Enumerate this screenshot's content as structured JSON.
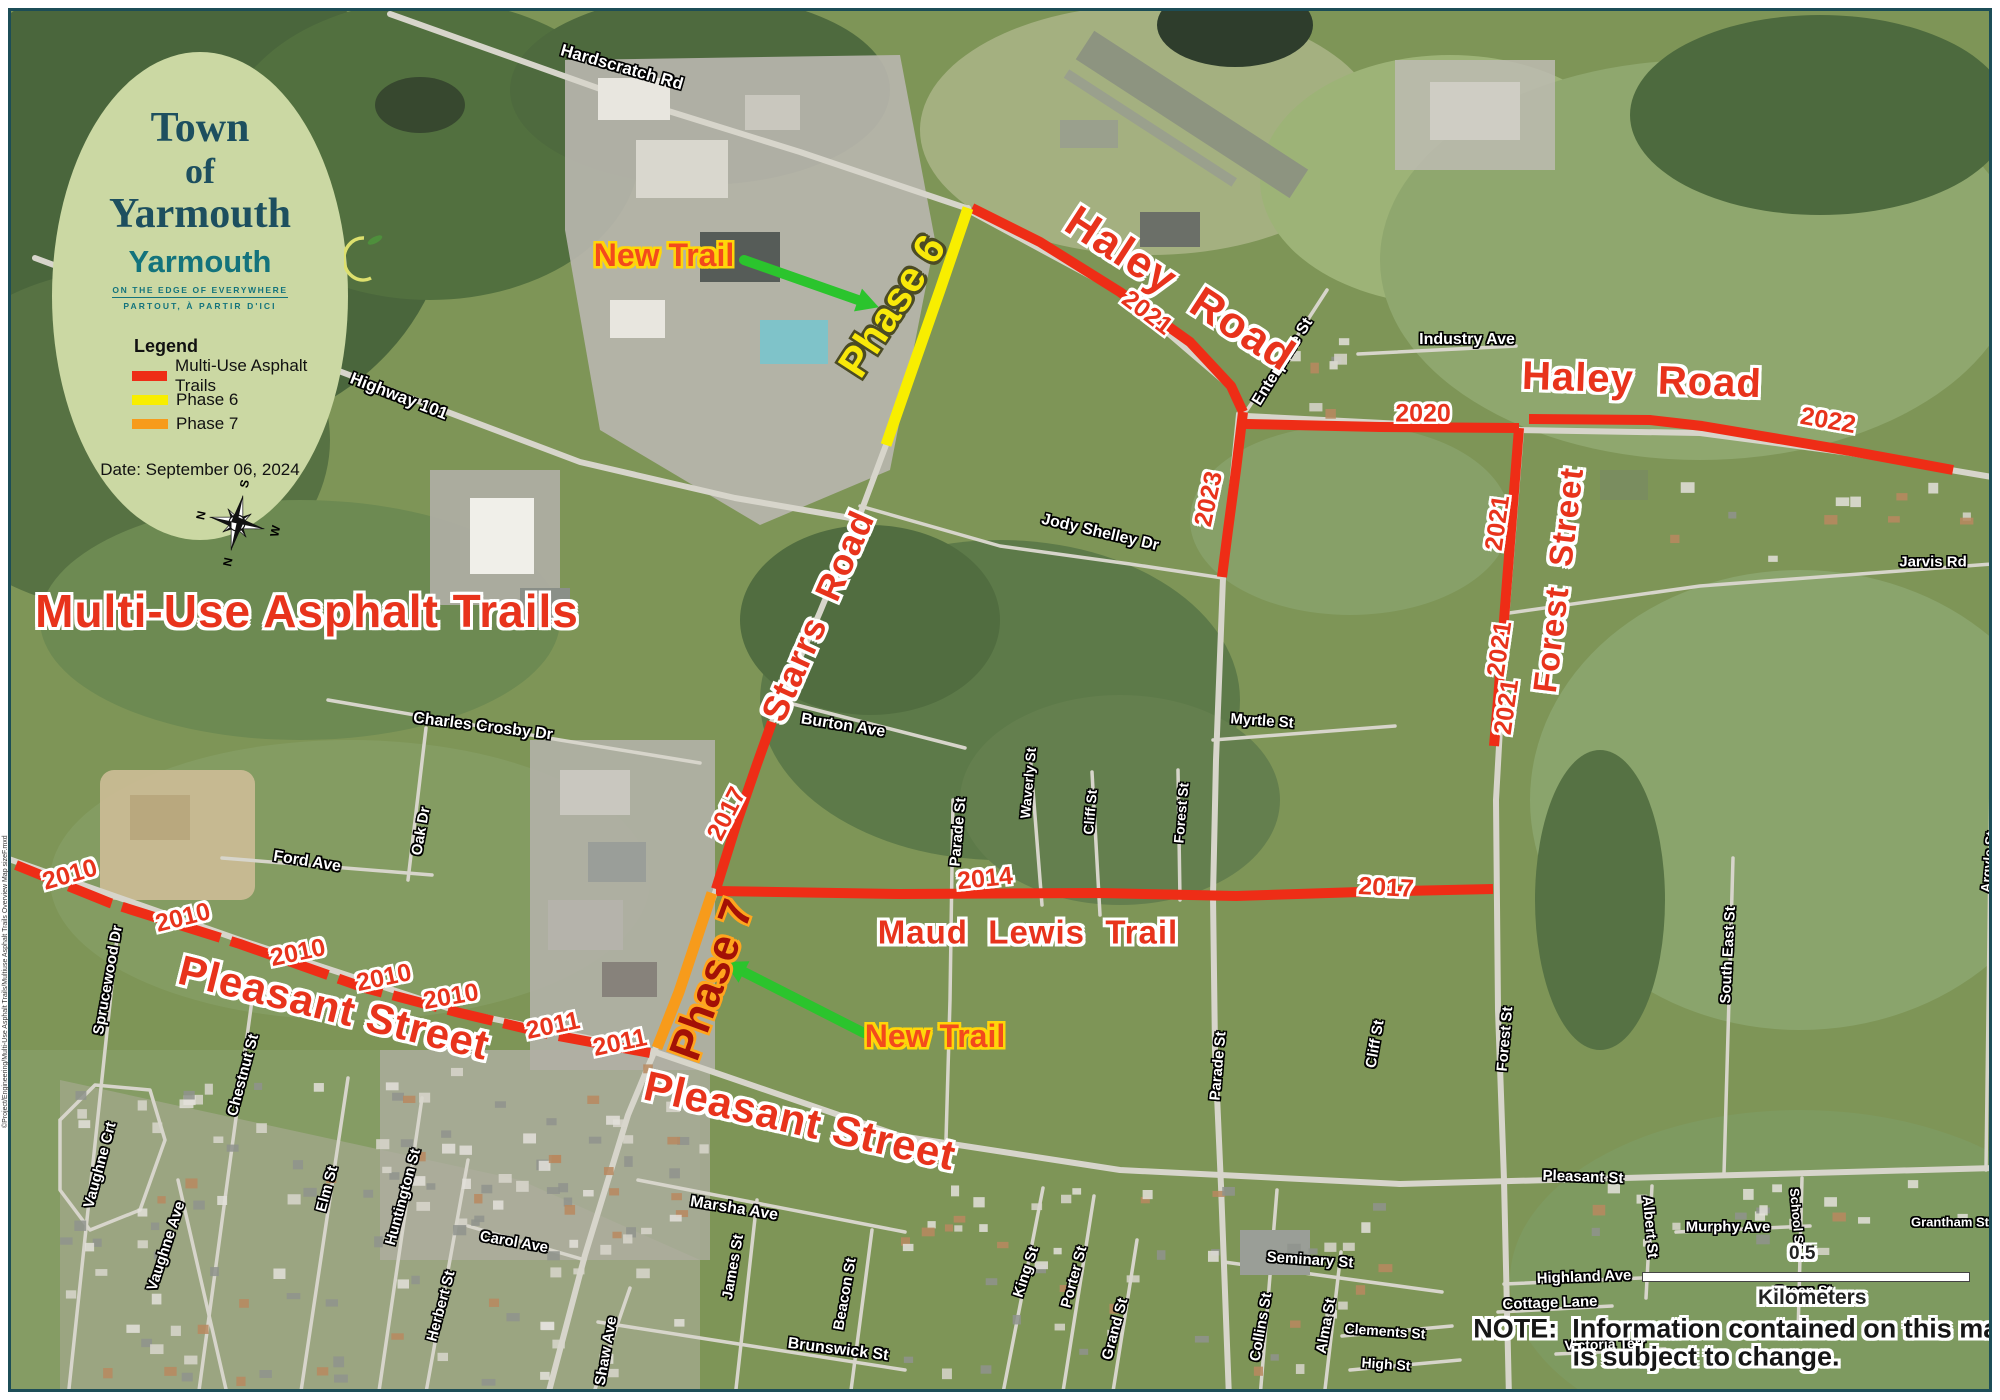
{
  "legend_card": {
    "title_line1": "Town",
    "title_line2": "of",
    "title_line3": "Yarmouth",
    "logo": {
      "name": "Yarmouth",
      "tagline1": "ON THE EDGE OF EVERYWHERE",
      "tagline2": "PARTOUT, À PARTIR D'ICI"
    },
    "legend_title": "Legend",
    "items": [
      {
        "label": "Multi-Use Asphalt Trails",
        "color": "#ee2d16"
      },
      {
        "label": "Phase 6",
        "color": "#f8ee00"
      },
      {
        "label": "Phase 7",
        "color": "#f79b1b"
      }
    ],
    "date_label": "Date: September 06, 2024",
    "compass": {
      "n": "N",
      "e": "E",
      "s": "S",
      "w": "W"
    }
  },
  "note": {
    "line1": "NOTE:  Information contained on this map",
    "line2": "is subject to change."
  },
  "scale_bar": {
    "value": "0.5",
    "unit": "Kilometers"
  },
  "credit_left": "©Project/Engineering/Multi-Use Asphalt Trails/Multiuse Asphalt Trails Overview Map sizeF.mxd",
  "colors": {
    "trail_red": "#ee2d16",
    "phase6_yellow": "#f8ee00",
    "phase7_orange": "#f79b1b",
    "label_red": "#e8331c",
    "arrow_green": "#2bc42d",
    "oval_bg": "#cbd8a3",
    "heading_teal": "#1d4f5f",
    "logo_teal": "#13737c",
    "border_teal": "#1c4d57"
  },
  "annotations": {
    "overlay_labels": [
      {
        "text": "Multi-Use Asphalt Trails",
        "x": 307,
        "y": 611,
        "rot": 0,
        "cls": "big-red",
        "size": 46
      },
      {
        "text": "Haley  Road",
        "x": 1180,
        "y": 289,
        "rot": 33,
        "cls": "big-red",
        "size": 44
      },
      {
        "text": "Haley  Road",
        "x": 1642,
        "y": 380,
        "rot": 2,
        "cls": "big-red",
        "size": 40
      },
      {
        "text": "Pleasant Street",
        "x": 334,
        "y": 1008,
        "rot": 14,
        "cls": "big-red",
        "size": 42
      },
      {
        "text": "Pleasant Street",
        "x": 800,
        "y": 1121,
        "rot": 13,
        "cls": "big-red",
        "size": 42
      },
      {
        "text": "Starrs  Road",
        "x": 818,
        "y": 616,
        "rot": -66,
        "cls": "big-red",
        "size": 36
      },
      {
        "text": "Forest  Street",
        "x": 1558,
        "y": 580,
        "rot": -83,
        "cls": "big-red",
        "size": 33
      },
      {
        "text": "Maud  Lewis  Trail",
        "x": 1028,
        "y": 932,
        "rot": 0,
        "cls": "big-red",
        "size": 33
      },
      {
        "text": "Phase 6",
        "x": 892,
        "y": 306,
        "rot": -57,
        "cls": "phase6",
        "size": 42
      },
      {
        "text": "Phase 7",
        "x": 712,
        "y": 980,
        "rot": -70,
        "cls": "phase7",
        "size": 44
      },
      {
        "text": "New Trail",
        "x": 664,
        "y": 255,
        "rot": 0,
        "cls": "newtrail",
        "size": 32
      },
      {
        "text": "New Trail",
        "x": 935,
        "y": 1036,
        "rot": 0,
        "cls": "newtrail",
        "size": 32
      },
      {
        "text": "2021",
        "x": 1147,
        "y": 313,
        "rot": 37,
        "cls": "year",
        "size": 25
      },
      {
        "text": "2020",
        "x": 1423,
        "y": 414,
        "rot": 0,
        "cls": "year",
        "size": 25
      },
      {
        "text": "2022",
        "x": 1828,
        "y": 421,
        "rot": 10,
        "cls": "year",
        "size": 25
      },
      {
        "text": "2023",
        "x": 1209,
        "y": 499,
        "rot": -78,
        "cls": "year",
        "size": 25
      },
      {
        "text": "2021",
        "x": 1498,
        "y": 523,
        "rot": -82,
        "cls": "year",
        "size": 25
      },
      {
        "text": "2021",
        "x": 1500,
        "y": 649,
        "rot": -82,
        "cls": "year",
        "size": 25
      },
      {
        "text": "2021",
        "x": 1507,
        "y": 707,
        "rot": -82,
        "cls": "year",
        "size": 25
      },
      {
        "text": "2017",
        "x": 727,
        "y": 814,
        "rot": -63,
        "cls": "year",
        "size": 25
      },
      {
        "text": "2014",
        "x": 985,
        "y": 879,
        "rot": -6,
        "cls": "year",
        "size": 25
      },
      {
        "text": "2017",
        "x": 1386,
        "y": 888,
        "rot": 3,
        "cls": "year",
        "size": 25
      },
      {
        "text": "2010",
        "x": 70,
        "y": 875,
        "rot": -16,
        "cls": "year",
        "size": 25
      },
      {
        "text": "2010",
        "x": 183,
        "y": 918,
        "rot": -14,
        "cls": "year",
        "size": 25
      },
      {
        "text": "2010",
        "x": 298,
        "y": 953,
        "rot": -12,
        "cls": "year",
        "size": 25
      },
      {
        "text": "2010",
        "x": 384,
        "y": 978,
        "rot": -12,
        "cls": "year",
        "size": 25
      },
      {
        "text": "2010",
        "x": 451,
        "y": 997,
        "rot": -10,
        "cls": "year",
        "size": 25
      },
      {
        "text": "2011",
        "x": 553,
        "y": 1026,
        "rot": -12,
        "cls": "year",
        "size": 25
      },
      {
        "text": "2011",
        "x": 620,
        "y": 1043,
        "rot": -12,
        "cls": "year",
        "size": 25
      }
    ],
    "street_labels": [
      {
        "text": "Hardscratch Rd",
        "x": 622,
        "y": 67,
        "rot": 16,
        "size": 17
      },
      {
        "text": "Highway 101",
        "x": 399,
        "y": 396,
        "rot": 21,
        "size": 17
      },
      {
        "text": "Jody Shelley Dr",
        "x": 1100,
        "y": 533,
        "rot": 13,
        "size": 16
      },
      {
        "text": "Enterprise St",
        "x": 1283,
        "y": 362,
        "rot": -58,
        "size": 16
      },
      {
        "text": "Industry Ave",
        "x": 1467,
        "y": 340,
        "rot": 0,
        "size": 16
      },
      {
        "text": "Jarvis Rd",
        "x": 1933,
        "y": 562,
        "rot": 0,
        "size": 15
      },
      {
        "text": "Myrtle St",
        "x": 1262,
        "y": 721,
        "rot": 4,
        "size": 15
      },
      {
        "text": "Burton Ave",
        "x": 843,
        "y": 726,
        "rot": 9,
        "size": 16
      },
      {
        "text": "Charles Crosby Dr",
        "x": 483,
        "y": 727,
        "rot": 7,
        "size": 16
      },
      {
        "text": "Oak Dr",
        "x": 421,
        "y": 831,
        "rot": -80,
        "size": 15
      },
      {
        "text": "Ford Ave",
        "x": 307,
        "y": 862,
        "rot": 9,
        "size": 16
      },
      {
        "text": "Sprucewood Dr",
        "x": 108,
        "y": 980,
        "rot": -80,
        "size": 15
      },
      {
        "text": "Chestnut St",
        "x": 243,
        "y": 1075,
        "rot": -75,
        "size": 15
      },
      {
        "text": "Vaughne Crt",
        "x": 100,
        "y": 1165,
        "rot": -75,
        "size": 15
      },
      {
        "text": "Vaughne Ave",
        "x": 166,
        "y": 1246,
        "rot": -72,
        "size": 15
      },
      {
        "text": "Elm St",
        "x": 327,
        "y": 1189,
        "rot": -75,
        "size": 15
      },
      {
        "text": "Huntington St",
        "x": 403,
        "y": 1197,
        "rot": -75,
        "size": 15
      },
      {
        "text": "Herbert St",
        "x": 441,
        "y": 1306,
        "rot": -75,
        "size": 15
      },
      {
        "text": "Carol Ave",
        "x": 514,
        "y": 1242,
        "rot": 10,
        "size": 15
      },
      {
        "text": "Shaw Ave",
        "x": 606,
        "y": 1351,
        "rot": -80,
        "size": 15
      },
      {
        "text": "Marsha Ave",
        "x": 734,
        "y": 1209,
        "rot": 9,
        "size": 16
      },
      {
        "text": "James St",
        "x": 733,
        "y": 1267,
        "rot": -80,
        "size": 15
      },
      {
        "text": "Beacon St",
        "x": 845,
        "y": 1294,
        "rot": -80,
        "size": 15
      },
      {
        "text": "Brunswick St",
        "x": 838,
        "y": 1350,
        "rot": 7,
        "size": 16
      },
      {
        "text": "King St",
        "x": 1026,
        "y": 1272,
        "rot": -72,
        "size": 15
      },
      {
        "text": "Porter St",
        "x": 1074,
        "y": 1277,
        "rot": -75,
        "size": 15
      },
      {
        "text": "Grand St",
        "x": 1115,
        "y": 1329,
        "rot": -75,
        "size": 15
      },
      {
        "text": "Parade St",
        "x": 958,
        "y": 832,
        "rot": -85,
        "size": 15
      },
      {
        "text": "Parade St",
        "x": 1218,
        "y": 1066,
        "rot": -85,
        "size": 15
      },
      {
        "text": "Waverly St",
        "x": 1028,
        "y": 783,
        "rot": -85,
        "size": 14
      },
      {
        "text": "Cliff St",
        "x": 1090,
        "y": 812,
        "rot": -85,
        "size": 14
      },
      {
        "text": "Forest St",
        "x": 1181,
        "y": 813,
        "rot": -85,
        "size": 14
      },
      {
        "text": "Cliff St",
        "x": 1375,
        "y": 1044,
        "rot": -80,
        "size": 15
      },
      {
        "text": "Forest St",
        "x": 1505,
        "y": 1039,
        "rot": -85,
        "size": 15
      },
      {
        "text": "South East St",
        "x": 1728,
        "y": 955,
        "rot": -87,
        "size": 15
      },
      {
        "text": "Seminary St",
        "x": 1310,
        "y": 1260,
        "rot": 4,
        "size": 15
      },
      {
        "text": "Collins St",
        "x": 1261,
        "y": 1327,
        "rot": -80,
        "size": 15
      },
      {
        "text": "Alma St",
        "x": 1326,
        "y": 1326,
        "rot": -80,
        "size": 15
      },
      {
        "text": "Clements St",
        "x": 1385,
        "y": 1331,
        "rot": 4,
        "size": 14
      },
      {
        "text": "High St",
        "x": 1386,
        "y": 1364,
        "rot": 4,
        "size": 14
      },
      {
        "text": "Pleasant St",
        "x": 1583,
        "y": 1177,
        "rot": 2,
        "size": 15
      },
      {
        "text": "Albert St",
        "x": 1650,
        "y": 1227,
        "rot": 85,
        "size": 15
      },
      {
        "text": "Murphy Ave",
        "x": 1728,
        "y": 1227,
        "rot": 0,
        "size": 15
      },
      {
        "text": "Highland Ave",
        "x": 1584,
        "y": 1277,
        "rot": -2,
        "size": 15
      },
      {
        "text": "Cottage Lane",
        "x": 1550,
        "y": 1303,
        "rot": -2,
        "size": 15
      },
      {
        "text": "Victoria Terr",
        "x": 1605,
        "y": 1344,
        "rot": -2,
        "size": 14
      },
      {
        "text": "Green St",
        "x": 1803,
        "y": 1290,
        "rot": 0,
        "size": 14
      },
      {
        "text": "School St",
        "x": 1797,
        "y": 1218,
        "rot": 85,
        "size": 13
      },
      {
        "text": "Grantham St",
        "x": 1950,
        "y": 1222,
        "rot": 0,
        "size": 13
      },
      {
        "text": "Argyle St",
        "x": 1988,
        "y": 862,
        "rot": -85,
        "size": 14
      }
    ],
    "arrows": [
      {
        "x1": 744,
        "y1": 260,
        "x2": 858,
        "y2": 300
      },
      {
        "x1": 864,
        "y1": 1033,
        "x2": 744,
        "y2": 972
      }
    ]
  },
  "trails": {
    "red": [
      [
        [
          972,
          208
        ],
        [
          1040,
          242
        ],
        [
          1120,
          292
        ],
        [
          1190,
          342
        ],
        [
          1231,
          386
        ],
        [
          1243,
          412
        ]
      ],
      [
        [
          1243,
          412
        ],
        [
          1236,
          470
        ],
        [
          1228,
          530
        ],
        [
          1222,
          577
        ]
      ],
      [
        [
          1246,
          424
        ],
        [
          1380,
          427
        ],
        [
          1519,
          428
        ]
      ],
      [
        [
          1519,
          428
        ],
        [
          1511,
          530
        ],
        [
          1504,
          620
        ],
        [
          1498,
          700
        ],
        [
          1494,
          746
        ]
      ],
      [
        [
          1529,
          419
        ],
        [
          1650,
          420
        ],
        [
          1702,
          426
        ],
        [
          1850,
          451
        ],
        [
          1953,
          470
        ]
      ],
      [
        [
          772,
          722
        ],
        [
          757,
          764
        ],
        [
          737,
          822
        ],
        [
          716,
          889
        ]
      ],
      [
        [
          716,
          891
        ],
        [
          900,
          894
        ],
        [
          1100,
          893
        ],
        [
          1236,
          896
        ],
        [
          1360,
          892
        ],
        [
          1493,
          889
        ]
      ]
    ],
    "red_dashed": [
      [
        [
          16,
          865
        ],
        [
          110,
          903
        ],
        [
          240,
          944
        ],
        [
          365,
          988
        ],
        [
          460,
          1013
        ],
        [
          553,
          1035
        ],
        [
          650,
          1053
        ]
      ]
    ],
    "yellow": [
      [
        [
          968,
          208
        ],
        [
          940,
          290
        ],
        [
          912,
          370
        ],
        [
          886,
          445
        ]
      ]
    ],
    "orange": [
      [
        [
          712,
          893
        ],
        [
          699,
          932
        ],
        [
          679,
          992
        ],
        [
          657,
          1048
        ]
      ]
    ]
  }
}
